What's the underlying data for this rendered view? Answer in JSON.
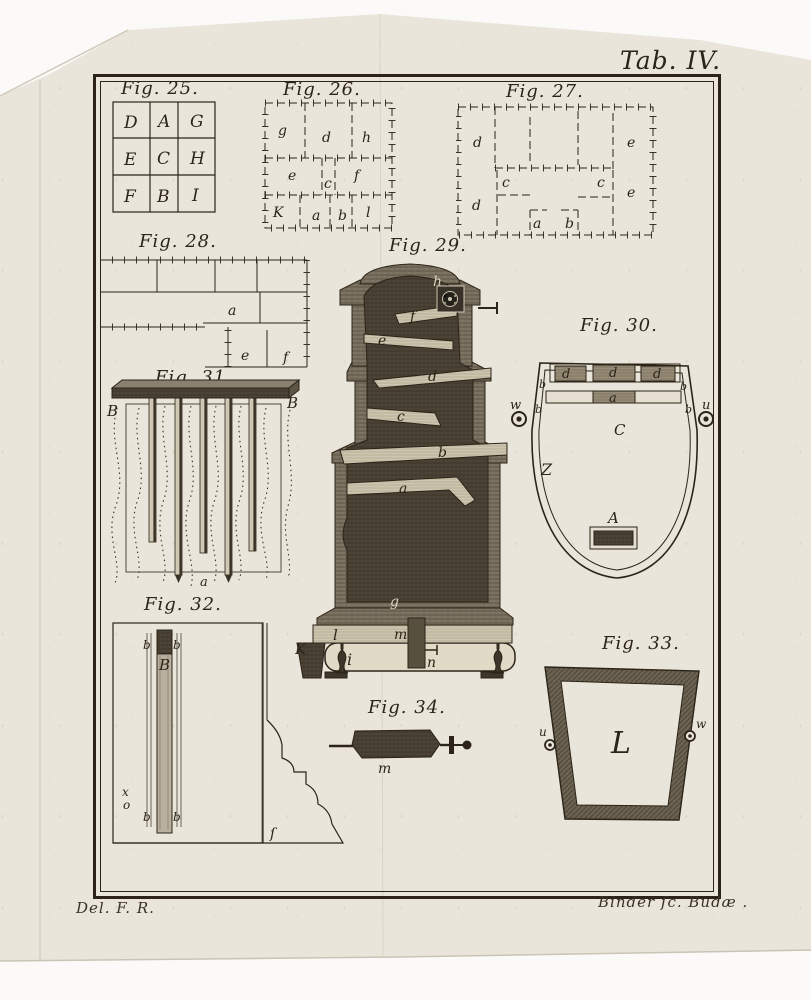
{
  "plate": {
    "title": "Tab. IV.",
    "credit_left": "Del. F. R.",
    "credit_right": "Binder ſc. Budæ .",
    "paper_color": "#e9e5da",
    "ink_color": "#2c2418"
  },
  "fig25": {
    "caption": "Fig. 25.",
    "cells": [
      "D",
      "A",
      "G",
      "E",
      "C",
      "H",
      "F",
      "B",
      "I"
    ]
  },
  "fig26": {
    "caption": "Fig. 26.",
    "rooms": [
      "g",
      "d",
      "h",
      "e",
      "c",
      "f",
      "K",
      "a",
      "b",
      "l"
    ]
  },
  "fig27": {
    "caption": "Fig. 27.",
    "rooms": [
      "d",
      "e",
      "c",
      "c",
      "e",
      "d",
      "a",
      "b"
    ]
  },
  "fig28": {
    "caption": "Fig. 28.",
    "bricks": [
      "a",
      "e",
      "f"
    ]
  },
  "fig29": {
    "caption": "Fig. 29.",
    "labels": {
      "h": "h",
      "f": "f",
      "e": "e",
      "d": "d",
      "c": "c",
      "b": "b",
      "a": "a",
      "g": "g",
      "K": "K",
      "l": "l",
      "m": "m",
      "i": "i",
      "n": "n"
    }
  },
  "fig30": {
    "caption": "Fig. 30.",
    "d_cells": [
      "d",
      "d",
      "d"
    ],
    "b_marks": [
      "b",
      "b",
      "b",
      "b"
    ],
    "a": "a",
    "C": "C",
    "Z": "Z",
    "A": "A",
    "w": "w",
    "u": "u"
  },
  "fig31": {
    "caption": "Fig. 31.",
    "B_left": "B",
    "B_right": "B",
    "a": "a"
  },
  "fig32": {
    "caption": "Fig. 32.",
    "b_marks": [
      "b",
      "b",
      "b",
      "b"
    ],
    "B": "B",
    "x": "x",
    "o": "o",
    "s_mark": "ſ"
  },
  "fig33": {
    "caption": "Fig. 33.",
    "u": "u",
    "L": "L",
    "w": "w"
  },
  "fig34": {
    "caption": "Fig. 34.",
    "m": "m"
  }
}
